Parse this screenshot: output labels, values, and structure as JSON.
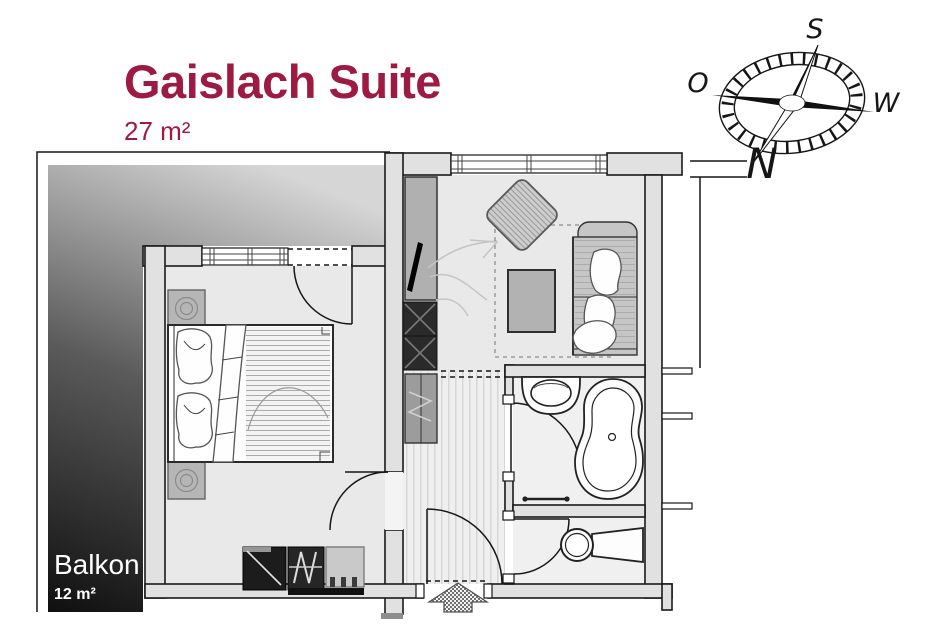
{
  "title": {
    "text": "Gaislach Suite",
    "area": "27 m²"
  },
  "balcony": {
    "label": "Balkon",
    "area": "12 m²"
  },
  "compass": {
    "south": "S",
    "west": "W",
    "north": "N",
    "east": "O"
  },
  "colors": {
    "accent": "#9d1a42",
    "balcony_text": "#ffffff",
    "wall_fill": "#e1e1e1",
    "outline": "#1a1a1a",
    "balcony_gradient_dark": "#111111",
    "balcony_gradient_light": "#d6d6d6"
  }
}
